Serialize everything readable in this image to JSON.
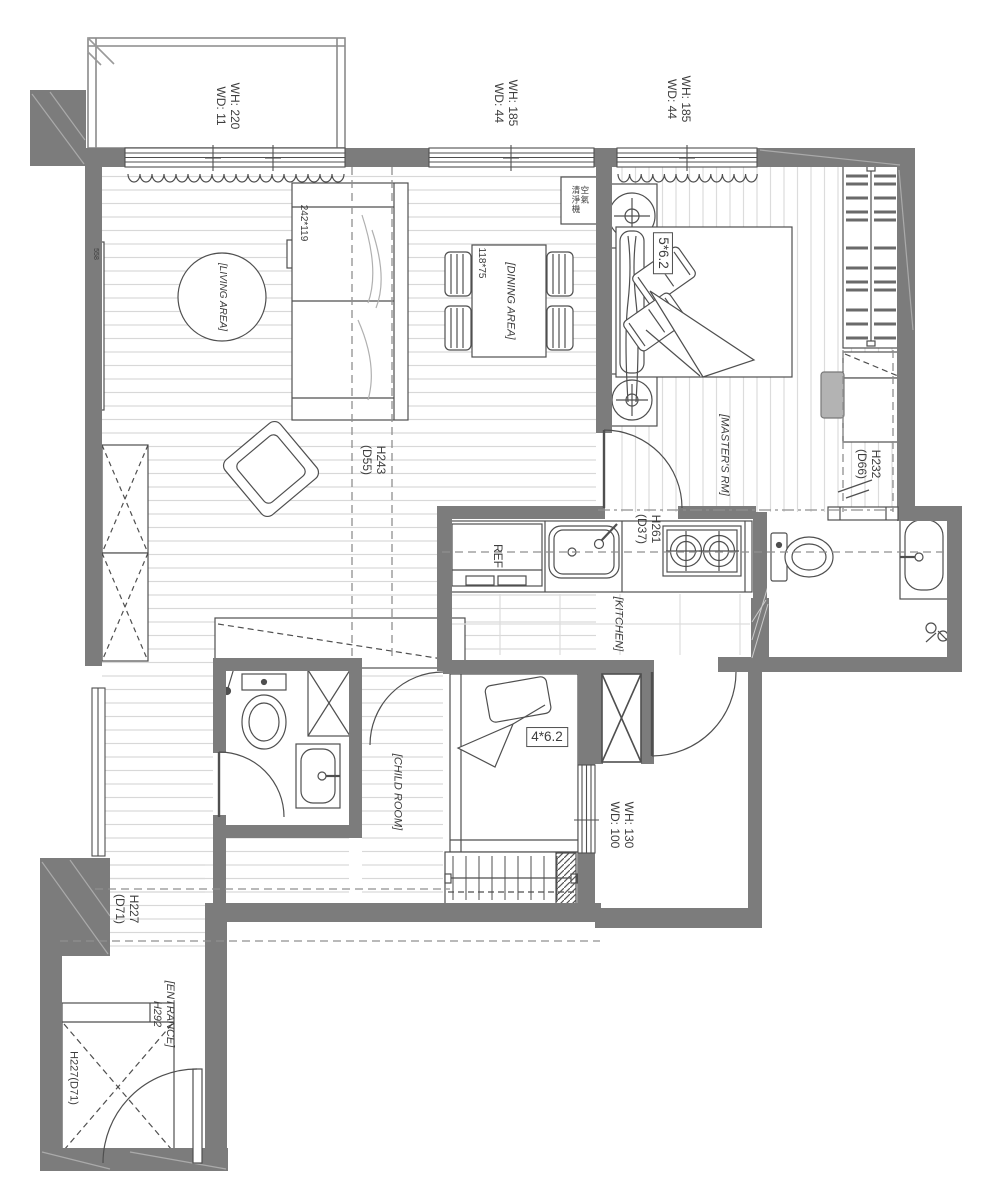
{
  "plan": {
    "title": "apartment floor plan",
    "colors": {
      "wall": "#7c7c7c",
      "line": "#4f4f4f",
      "floor_line": "#d8d8d8",
      "dash": "#8f8f8f"
    },
    "windows": {
      "balcony": {
        "l1": "WH: 220",
        "l2": "WD: 11"
      },
      "living": {
        "l1": "WH: 185",
        "l2": "WD: 44"
      },
      "master": {
        "l1": "WH: 185",
        "l2": "WD: 44"
      },
      "child": {
        "l1": "WH: 130",
        "l2": "WD: 100"
      }
    },
    "rooms": {
      "living": "[LIVING AREA]",
      "dining": "[DINING AREA]",
      "master": "[MASTER'S RM]",
      "kitchen": "[KITCHEN]",
      "child": "[CHILD ROOM]",
      "entrance": "[ENTRANCE]",
      "entrance_height": "H292"
    },
    "beams": {
      "living": {
        "l1": "H243",
        "l2": "(D55)"
      },
      "closet": {
        "l1": "H232",
        "l2": "(D66)"
      },
      "kitchen": {
        "l1": "H261",
        "l2": "(D37)"
      },
      "corridor": {
        "l1": "H227",
        "l2": "(D71)"
      },
      "entrance_cabinet": "H227(D71)"
    },
    "furniture": {
      "sofa_size": "242*119",
      "dining_table_size": "118*75",
      "master_bed_size": "5*6.2",
      "child_bed_size": "4*6.2",
      "fridge": "REF",
      "air_purifier_l1": "空氣",
      "air_purifier_l2": "清淨機",
      "wall_note": "558"
    }
  }
}
